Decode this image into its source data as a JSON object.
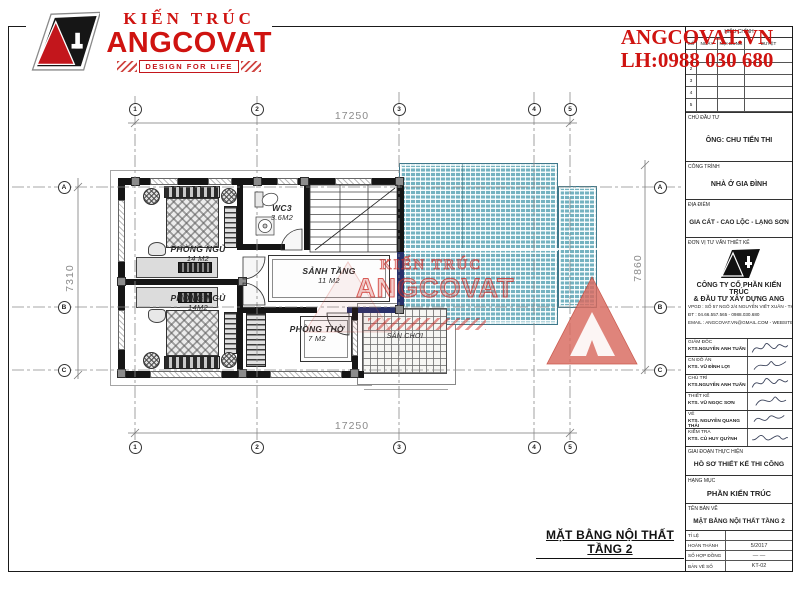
{
  "brand": {
    "logo_title": "KIẾN TRÚC",
    "logo_name": "ANGCOVAT",
    "logo_tagline": "DESIGN FOR LIFE",
    "website": "ANGCOVAT.VN",
    "hotline": "LH:0988 030 680"
  },
  "watermark": {
    "line1": "KIẾN TRÚC",
    "line2": "ANGCOVAT"
  },
  "plan": {
    "title": "MẶT BẰNG NỘI THẤT TẦNG 2",
    "dims": {
      "top": "17250",
      "bottom": "17250",
      "left": "7310",
      "right": "7860"
    },
    "grid_cols": [
      "1",
      "2",
      "3",
      "4",
      "5"
    ],
    "grid_rows": [
      "A",
      "B",
      "C"
    ],
    "rooms": {
      "bedroom1": {
        "name": "PHÒNG NGỦ",
        "area": "14 M2"
      },
      "bedroom2": {
        "name": "PHÒNG NGỦ",
        "area": "14M2"
      },
      "wc": {
        "name": "WC3",
        "area": "3.6M2"
      },
      "hall": {
        "name": "SẢNH TẦNG",
        "area": "11 M2"
      },
      "worship": {
        "name": "PHÒNG THỜ",
        "area": "7 M2"
      },
      "playground": {
        "name": "SÂN CHƠI"
      }
    }
  },
  "titleblock": {
    "revision": {
      "title": "HIỆU CHỈNH",
      "cols": [
        "SỐ",
        "NGÀY",
        "NỘI DUNG",
        "DUYỆT"
      ],
      "rows": [
        "1",
        "2",
        "3",
        "4",
        "5"
      ]
    },
    "owner": {
      "label": "CHỦ ĐẦU TƯ",
      "value": "ÔNG: CHU TIẾN THI"
    },
    "project": {
      "label": "CÔNG TRÌNH",
      "value": "NHÀ Ở GIA ĐÌNH"
    },
    "location": {
      "label": "ĐỊA ĐIỂM",
      "value": "GIA CÁT - CAO LỘC - LẠNG SƠN"
    },
    "company": {
      "label": "ĐƠN VỊ TƯ VẤN THIẾT KẾ",
      "name1": "CÔNG TY CỔ PHẦN KIẾN TRÚC",
      "name2": "& ĐẦU TƯ XÂY DỰNG ANG",
      "addr": "VPGD : SỐ 57 NGÕ 2/4 NGUYỄN VIẾT XUÂN - THANH XUÂN - HÀ NỘI",
      "tel": "ĐT : 04.66.557.565 - 0988.030.680",
      "email": "EMAIL : ANGCOVAT.VN@GMAIL.COM - WEBSITE : ANGCOVAT.VN"
    },
    "signers": [
      {
        "role": "GIÁM ĐỐC",
        "name": "KTS.NGUYỄN ANH TUẤN"
      },
      {
        "role": "CN ĐỒ ÁN",
        "name": "KTS. VŨ ĐÌNH LỢI"
      },
      {
        "role": "CHỦ TRÌ",
        "name": "KTS.NGUYỄN ANH TUẤN"
      },
      {
        "role": "THIẾT KẾ",
        "name": "KTS. VŨ NGỌC SƠN"
      },
      {
        "role": "VẼ",
        "name": "KTS. NGUYỄN QUANG THÁI"
      },
      {
        "role": "KIỂM TRA",
        "name": "KTS. CÙ HUY QUỲNH"
      }
    ],
    "stage": {
      "label": "GIAI ĐOẠN THỰC HIỆN",
      "value": "HỒ SƠ THIẾT KẾ THI CÔNG"
    },
    "category": {
      "label": "HẠNG MỤC",
      "value": "PHẦN KIẾN TRÚC"
    },
    "drawing": {
      "label": "TÊN BẢN VẼ",
      "value": "MẶT BẰNG NỘI THẤT TẦNG 2"
    },
    "meta": [
      {
        "label": "TỈ LỆ",
        "value": ""
      },
      {
        "label": "HOÀN THÀNH",
        "value": "5/2017"
      },
      {
        "label": "SỐ HỢP ĐỒNG",
        "value": "—   —"
      },
      {
        "label": "BẢN VẼ SỐ",
        "value": "KT-02"
      }
    ]
  }
}
